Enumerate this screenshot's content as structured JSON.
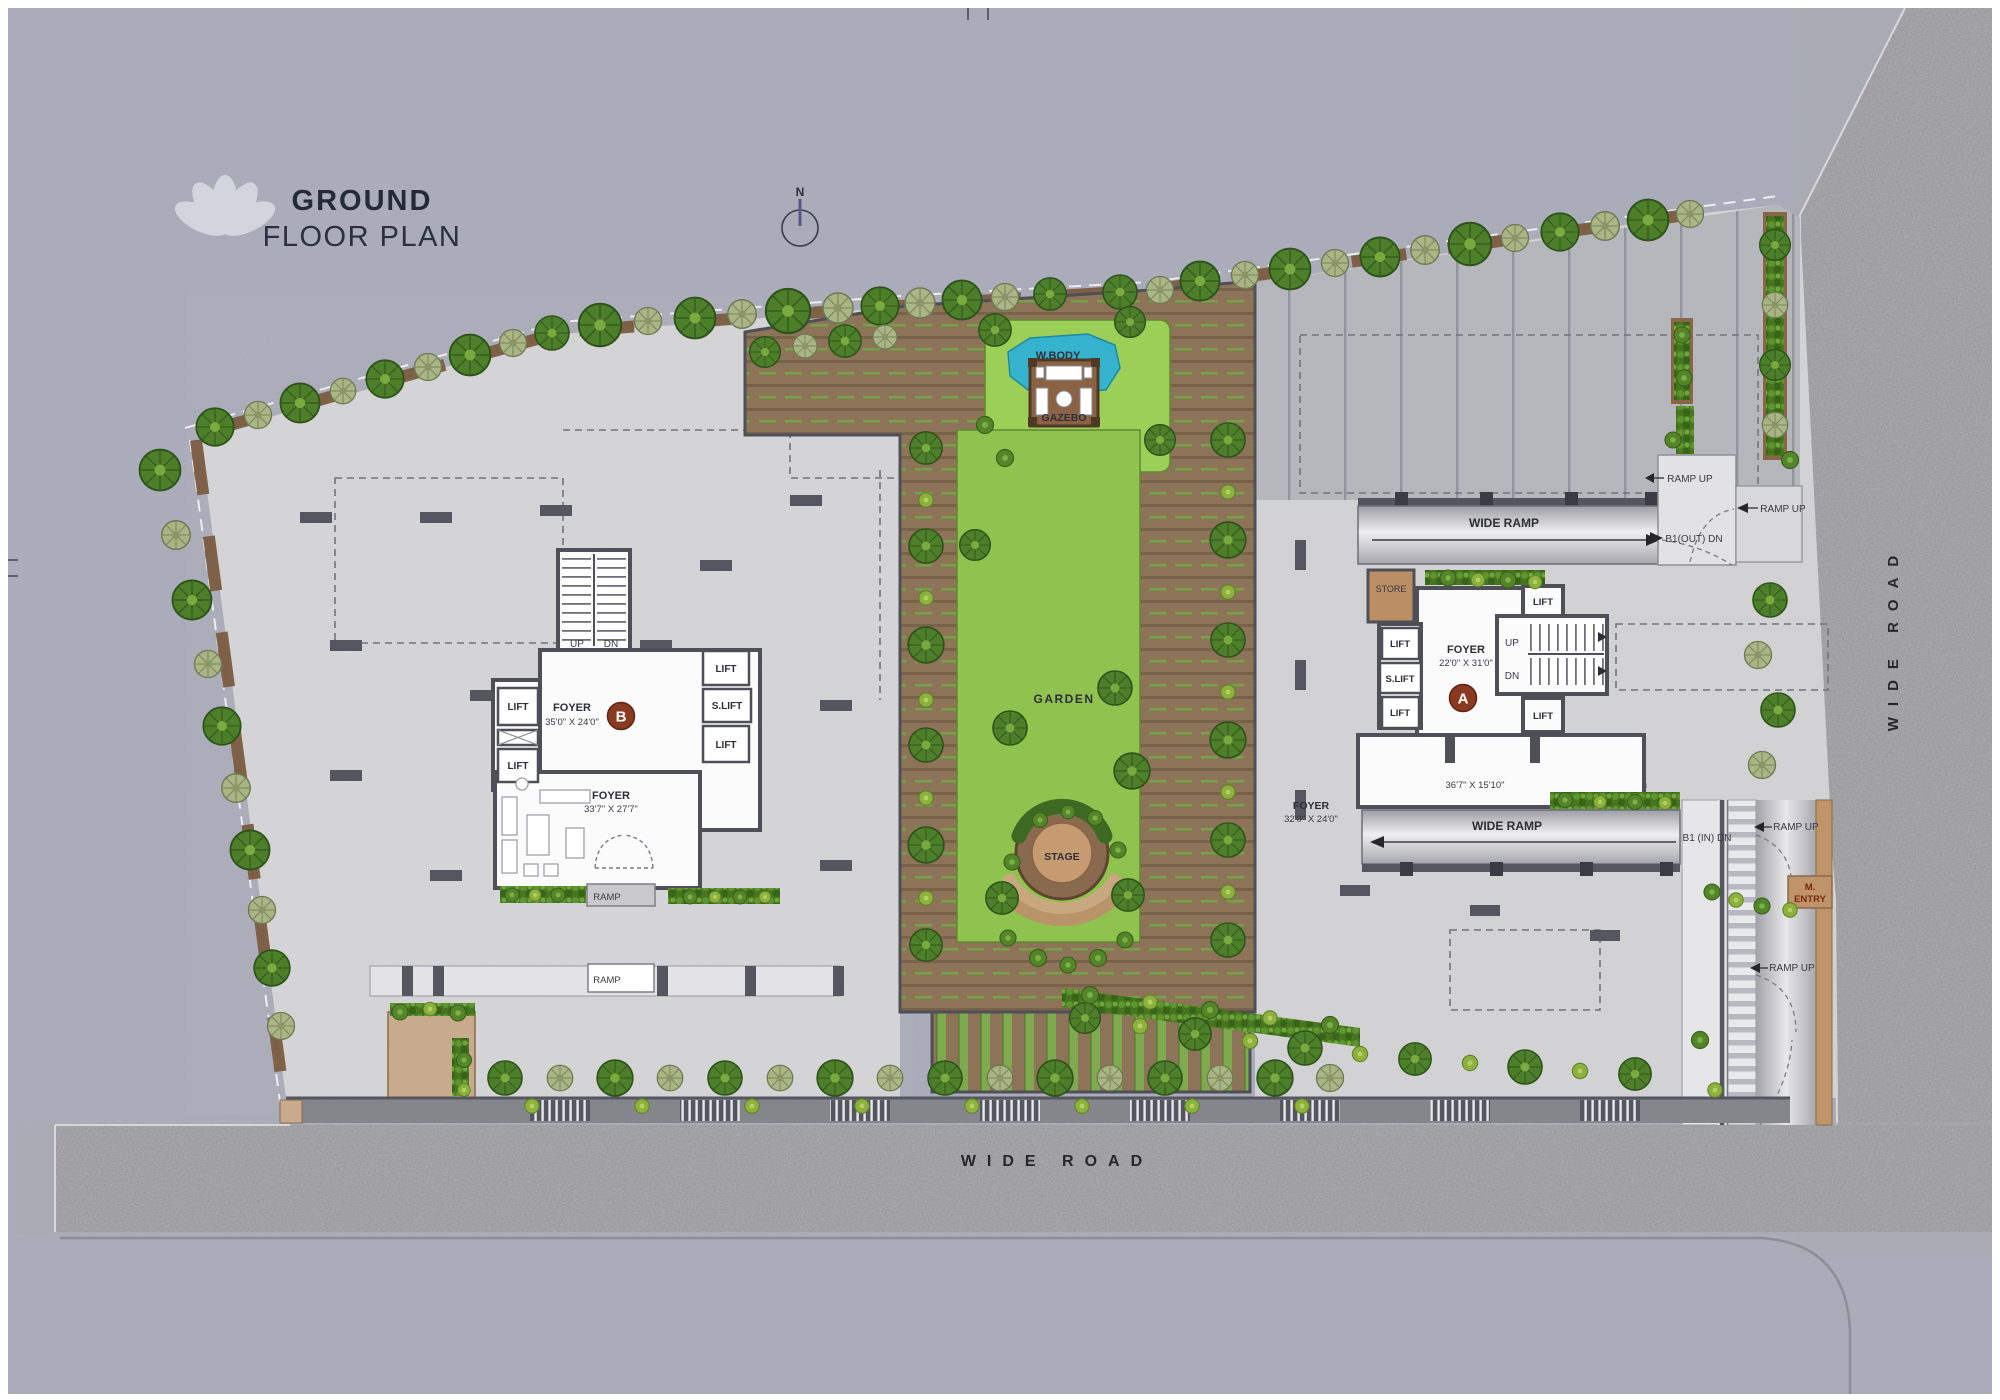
{
  "header": {
    "line1": "GROUND",
    "line2": "FLOOR PLAN"
  },
  "compass": {
    "label": "N"
  },
  "roads": {
    "bottom": "WIDE ROAD",
    "right": "WIDE ROAD"
  },
  "tower_b": {
    "badge": "B",
    "stair": {
      "up": "UP",
      "dn": "DN"
    },
    "lifts_left": [
      "LIFT",
      "LIFT"
    ],
    "lifts_right": [
      "LIFT",
      "S.LIFT",
      "LIFT"
    ],
    "foyer": {
      "label": "FOYER",
      "dim": "35'0\" X 24'0\""
    },
    "foyer2": {
      "label": "FOYER",
      "dim": "33'7\" X 27'7\""
    },
    "ramps": [
      "RAMP",
      "RAMP"
    ]
  },
  "tower_a": {
    "badge": "A",
    "store": "STORE",
    "stair": {
      "up": "UP",
      "dn": "DN"
    },
    "lifts_left": [
      "LIFT",
      "S.LIFT",
      "LIFT"
    ],
    "lifts_right": [
      "LIFT",
      "LIFT"
    ],
    "foyer": {
      "label": "FOYER",
      "dim": "22'0\" X 31'0\""
    },
    "room_dim": "36'7\" X 15'10\"",
    "foyer2": {
      "label": "FOYER",
      "dim": "32'0\" X 24'0\""
    }
  },
  "garden": {
    "water": "W.BODY",
    "gazebo": "GAZEBO",
    "lawn": "GARDEN",
    "stage": "STAGE"
  },
  "circulation": {
    "wide_ramp_top": "WIDE RAMP",
    "wide_ramp_bottom": "WIDE RAMP",
    "ramp_up": [
      "RAMP UP",
      "RAMP UP",
      "RAMP UP",
      "RAMP UP"
    ],
    "b1_out": "B1(OUT) DN",
    "b1_in": "B1 (IN) DN",
    "m_entry": [
      "M.",
      "ENTRY"
    ]
  },
  "colors": {
    "badge": "#8a3a20",
    "lawn": "#8fc24e",
    "water": "#35b2cc",
    "deck": "#8d7357",
    "road_text": "#26262c",
    "title": "#242a38",
    "background": "#abacb9"
  }
}
